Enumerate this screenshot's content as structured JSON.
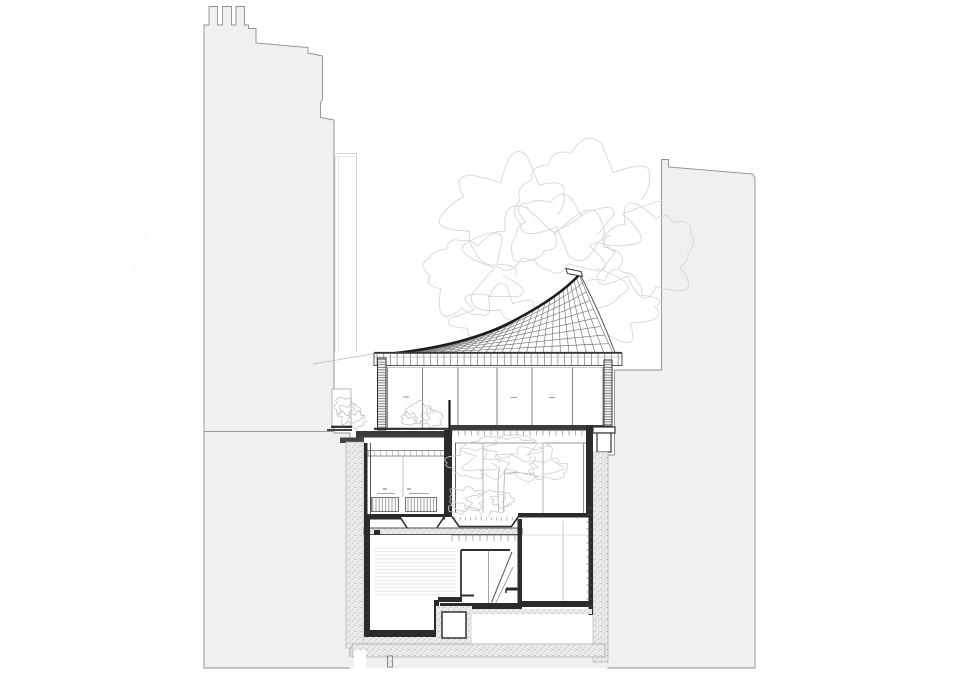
{
  "palette": {
    "background": "#ffffff",
    "context_fill": "#f0f0f0",
    "context_outline": "#8f8f8f",
    "line_dark": "#1c1c1c",
    "line_mid": "#555555",
    "line_soft": "#8a8a8a",
    "line_faint": "#bbbbbb",
    "fill_dark": "#2b2b2b",
    "tree_outline": "#d6d6d6",
    "inner_tree_outline": "#cfcfcf",
    "bush_outline": "#c4c4c4",
    "mound_outline": "#c9c9c9",
    "stripe": "#e2e2e2",
    "stipple_bg": "#ebebeb",
    "stipple_dot": "#a8a8a8"
  },
  "labels": {
    "drawing": "Sectional drawing of building with curved tiled roof",
    "left_building": "Left neighbouring building outline with chimneys",
    "right_building": "Right neighbouring building outline",
    "annex": "Rear annex outline of left building",
    "background_tree": "Background tree canopy",
    "roof": "Curved tiled roof with fanned tile courses",
    "ridge_cap": "Ridge cap at roof peak",
    "eave": "Eaves band with rafter ticks",
    "pavilion": "Glazed pavilion storey with mullions",
    "ground_floor": "Ground floor rooms",
    "courtyard_tree": "Interior courtyard tree",
    "basement": "Basement storey with stair",
    "lower_basement": "Lower basement rooms",
    "foundation": "Foundation strip and ground",
    "left_wall": "Left retaining wall",
    "right_wall": "Right party wall"
  }
}
